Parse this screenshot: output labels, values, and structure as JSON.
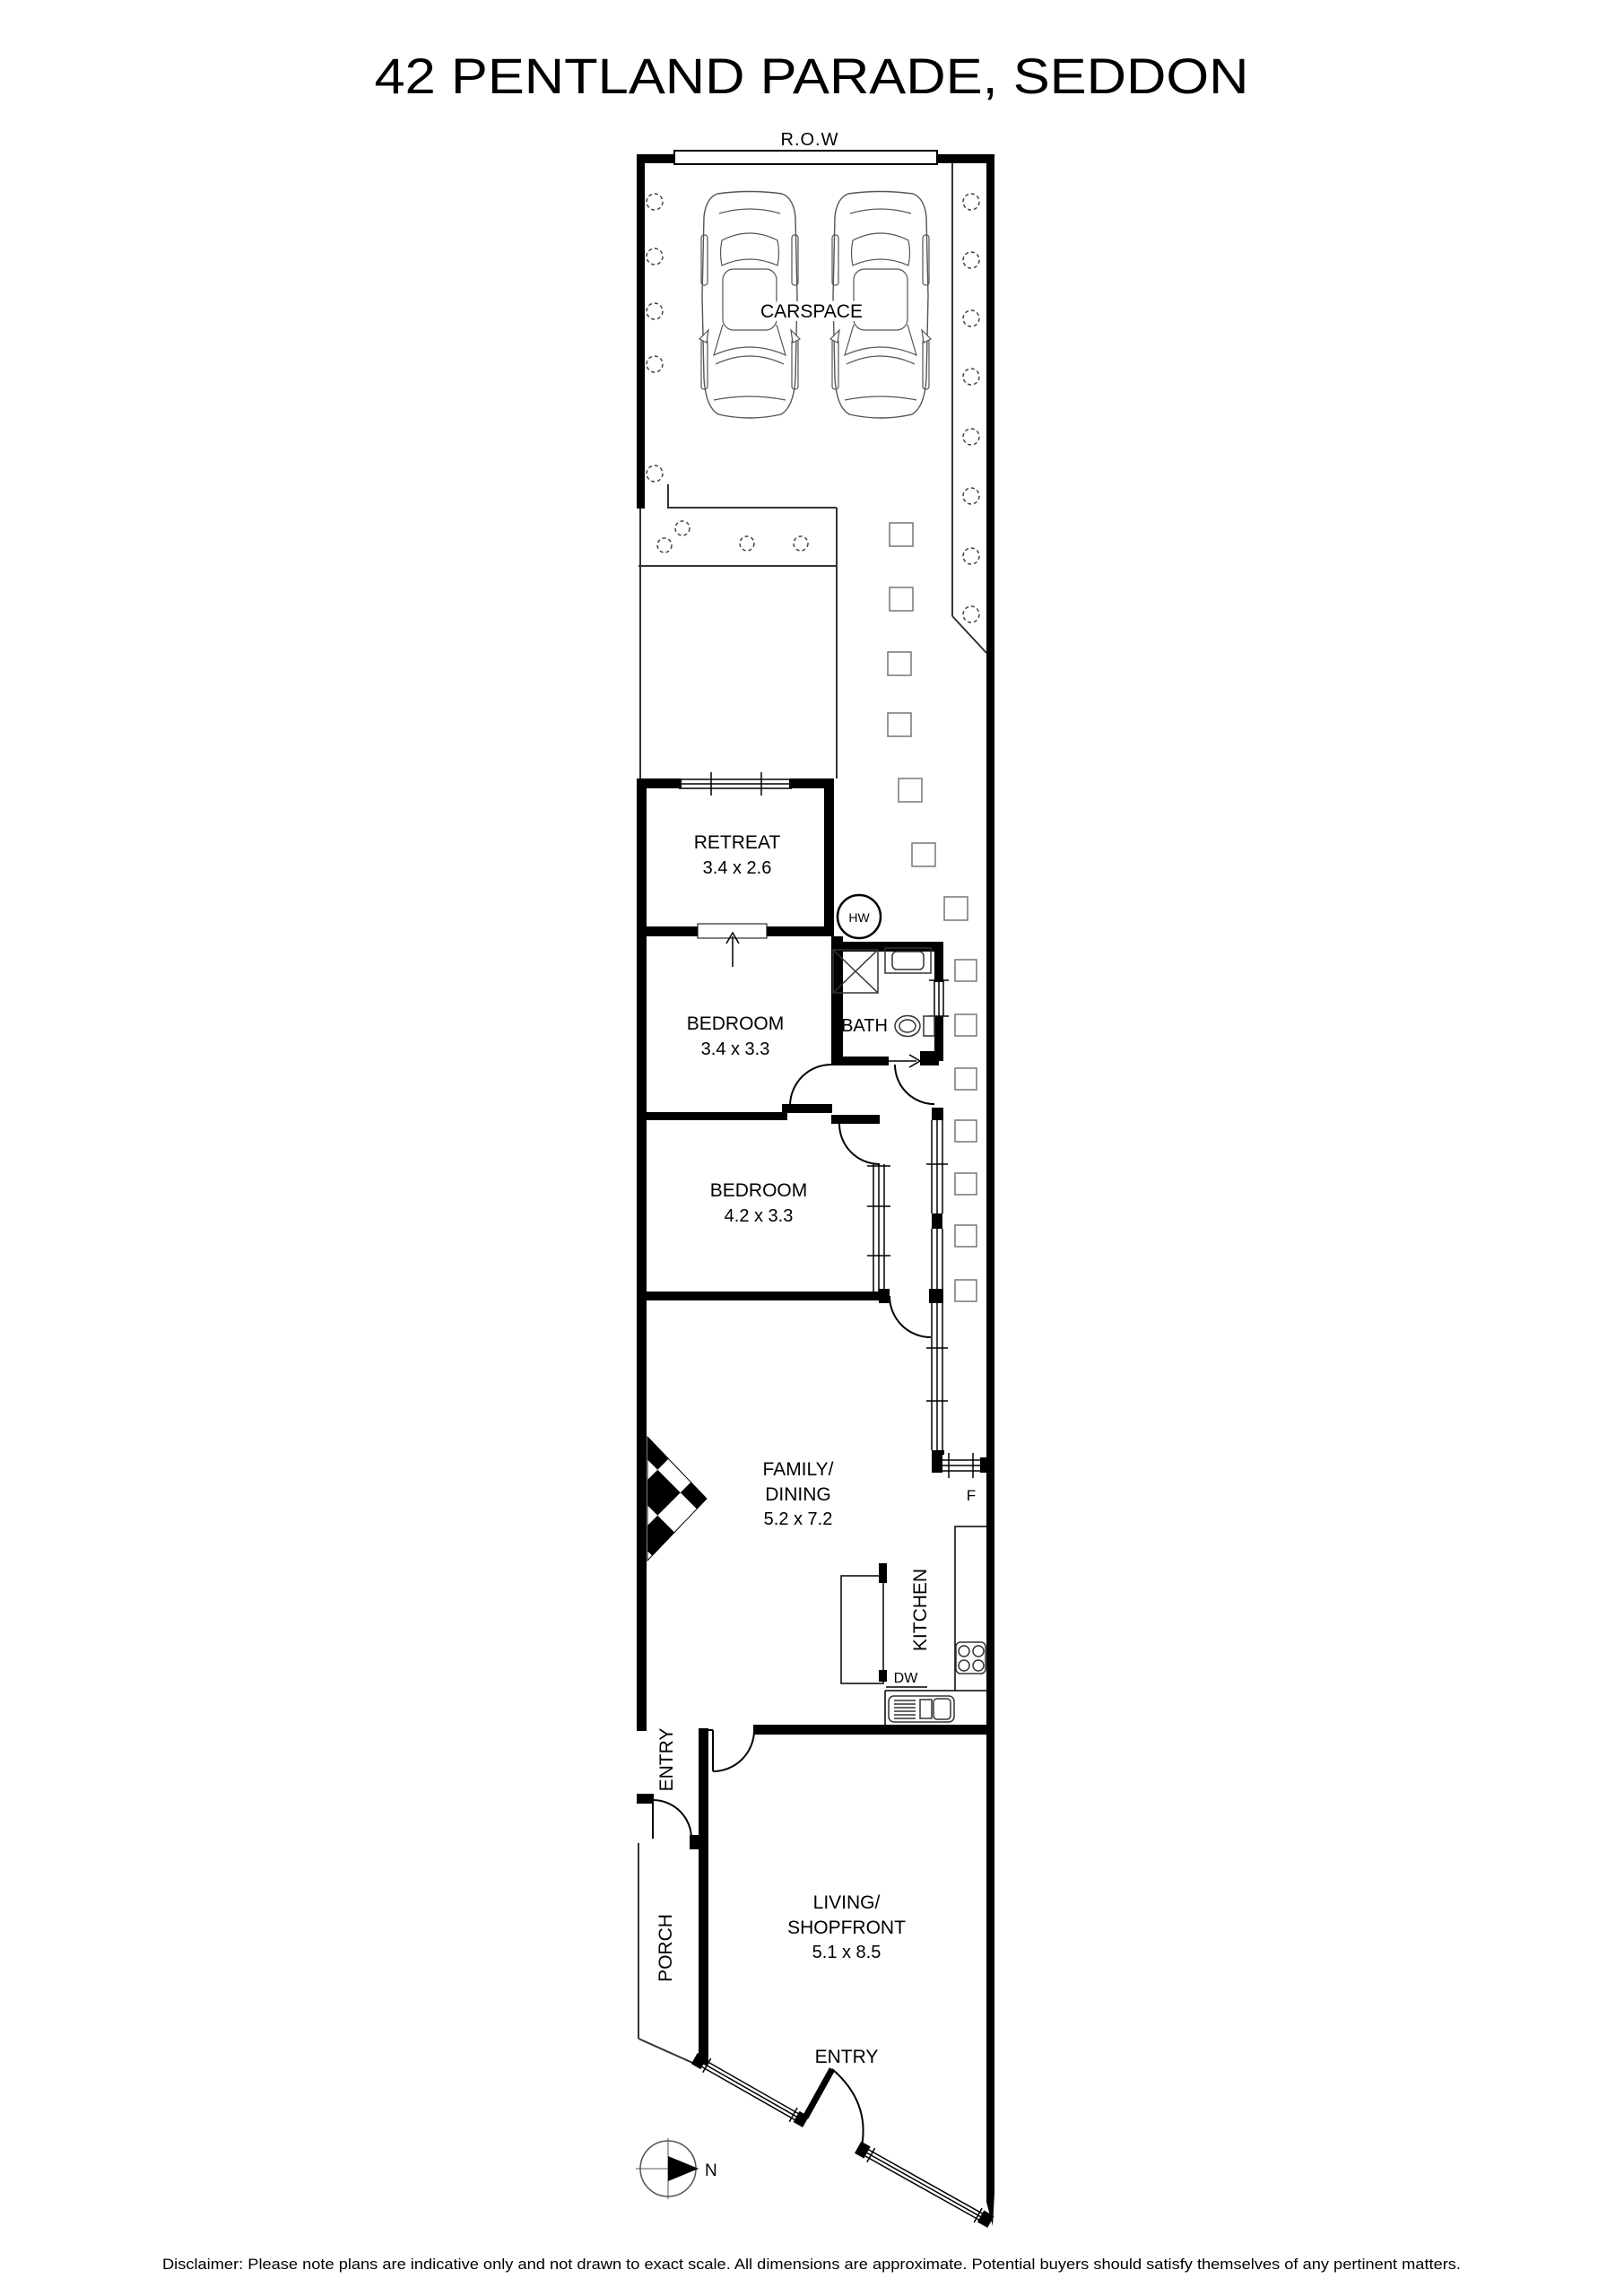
{
  "title": "42 PENTLAND PARADE, SEDDON",
  "row_label": "R.O.W",
  "compass": {
    "north": "N"
  },
  "rooms": {
    "carspace": {
      "name": "CARSPACE"
    },
    "retreat": {
      "name": "RETREAT",
      "dims": "3.4 x 2.6"
    },
    "bedroom1": {
      "name": "BEDROOM",
      "dims": "3.4 x 3.3"
    },
    "bath": {
      "name": "BATH"
    },
    "bedroom2": {
      "name": "BEDROOM",
      "dims": "4.2 x 3.3"
    },
    "family": {
      "name_line1": "FAMILY/",
      "name_line2": "DINING",
      "dims": "5.2 x 7.2"
    },
    "kitchen": {
      "name": "KITCHEN"
    },
    "entry_hall": {
      "name": "ENTRY"
    },
    "porch": {
      "name": "PORCH"
    },
    "living": {
      "name_line1": "LIVING/",
      "name_line2": "SHOPFRONT",
      "dims": "5.1 x 8.5"
    },
    "shop_entry": {
      "name": "ENTRY"
    }
  },
  "fixtures": {
    "hot_water": "HW",
    "dishwasher": "DW",
    "fridge": "F"
  },
  "disclaimer": "Disclaimer: Please note plans are indicative only and not drawn to exact scale. All dimensions are approximate. Potential buyers should satisfy themselves of any pertinent matters.",
  "colors": {
    "wall": "#000000",
    "paper": "#ffffff",
    "thin_line": "#333333",
    "fixture_line": "#555555",
    "paver_line": "#777777"
  }
}
